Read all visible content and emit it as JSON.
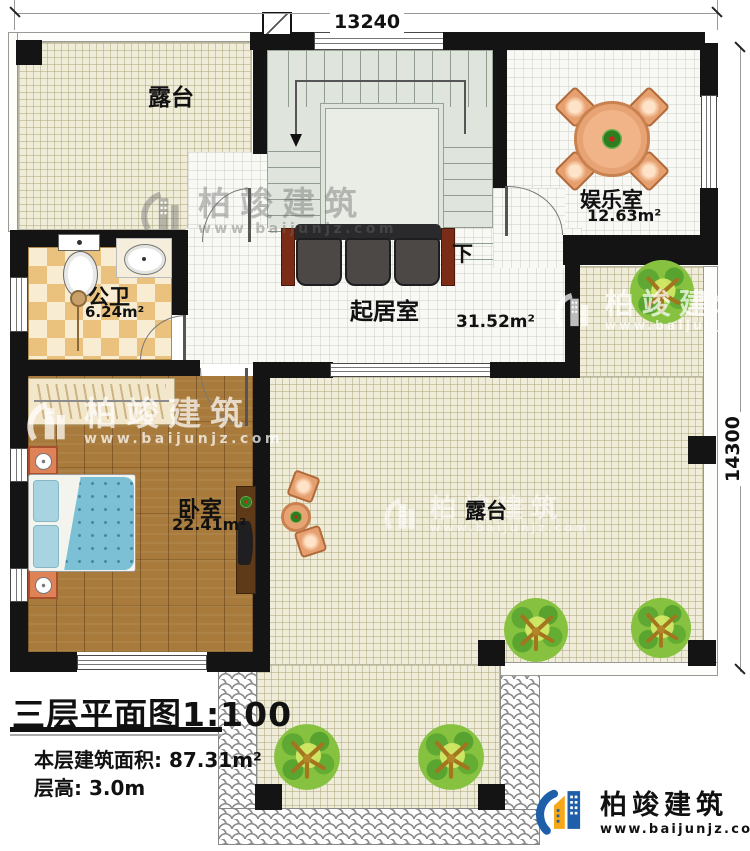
{
  "plan": {
    "dimensions": {
      "top": "13240",
      "right": "14300"
    },
    "rooms": {
      "terrace_top_left": {
        "name": "露台"
      },
      "entertainment": {
        "name": "娱乐室",
        "area": "12.63m²"
      },
      "bathroom": {
        "name": "公卫",
        "area": "6.24m²"
      },
      "living": {
        "name": "起居室",
        "area": "31.52m²"
      },
      "bedroom": {
        "name": "卧室",
        "area": "22.41m²"
      },
      "terrace_main": {
        "name": "露台"
      }
    },
    "stairs": {
      "down_label": "下"
    },
    "title_block": {
      "title": "三层平面图1:100",
      "area_line": "本层建筑面积: 87.31m²",
      "height_line": "层高: 3.0m"
    },
    "branding": {
      "company": "柏竣建筑",
      "website": "www.baijunjz.com"
    },
    "colors": {
      "wall": "#141414",
      "terrace_floor": "#efecd9",
      "stair_floor": "#dfe5dc",
      "wood_floor": "#a87a3b",
      "bath_tile": "#eac17d",
      "logo_blue": "#1d5fa8",
      "logo_yellow": "#f6a818"
    }
  }
}
